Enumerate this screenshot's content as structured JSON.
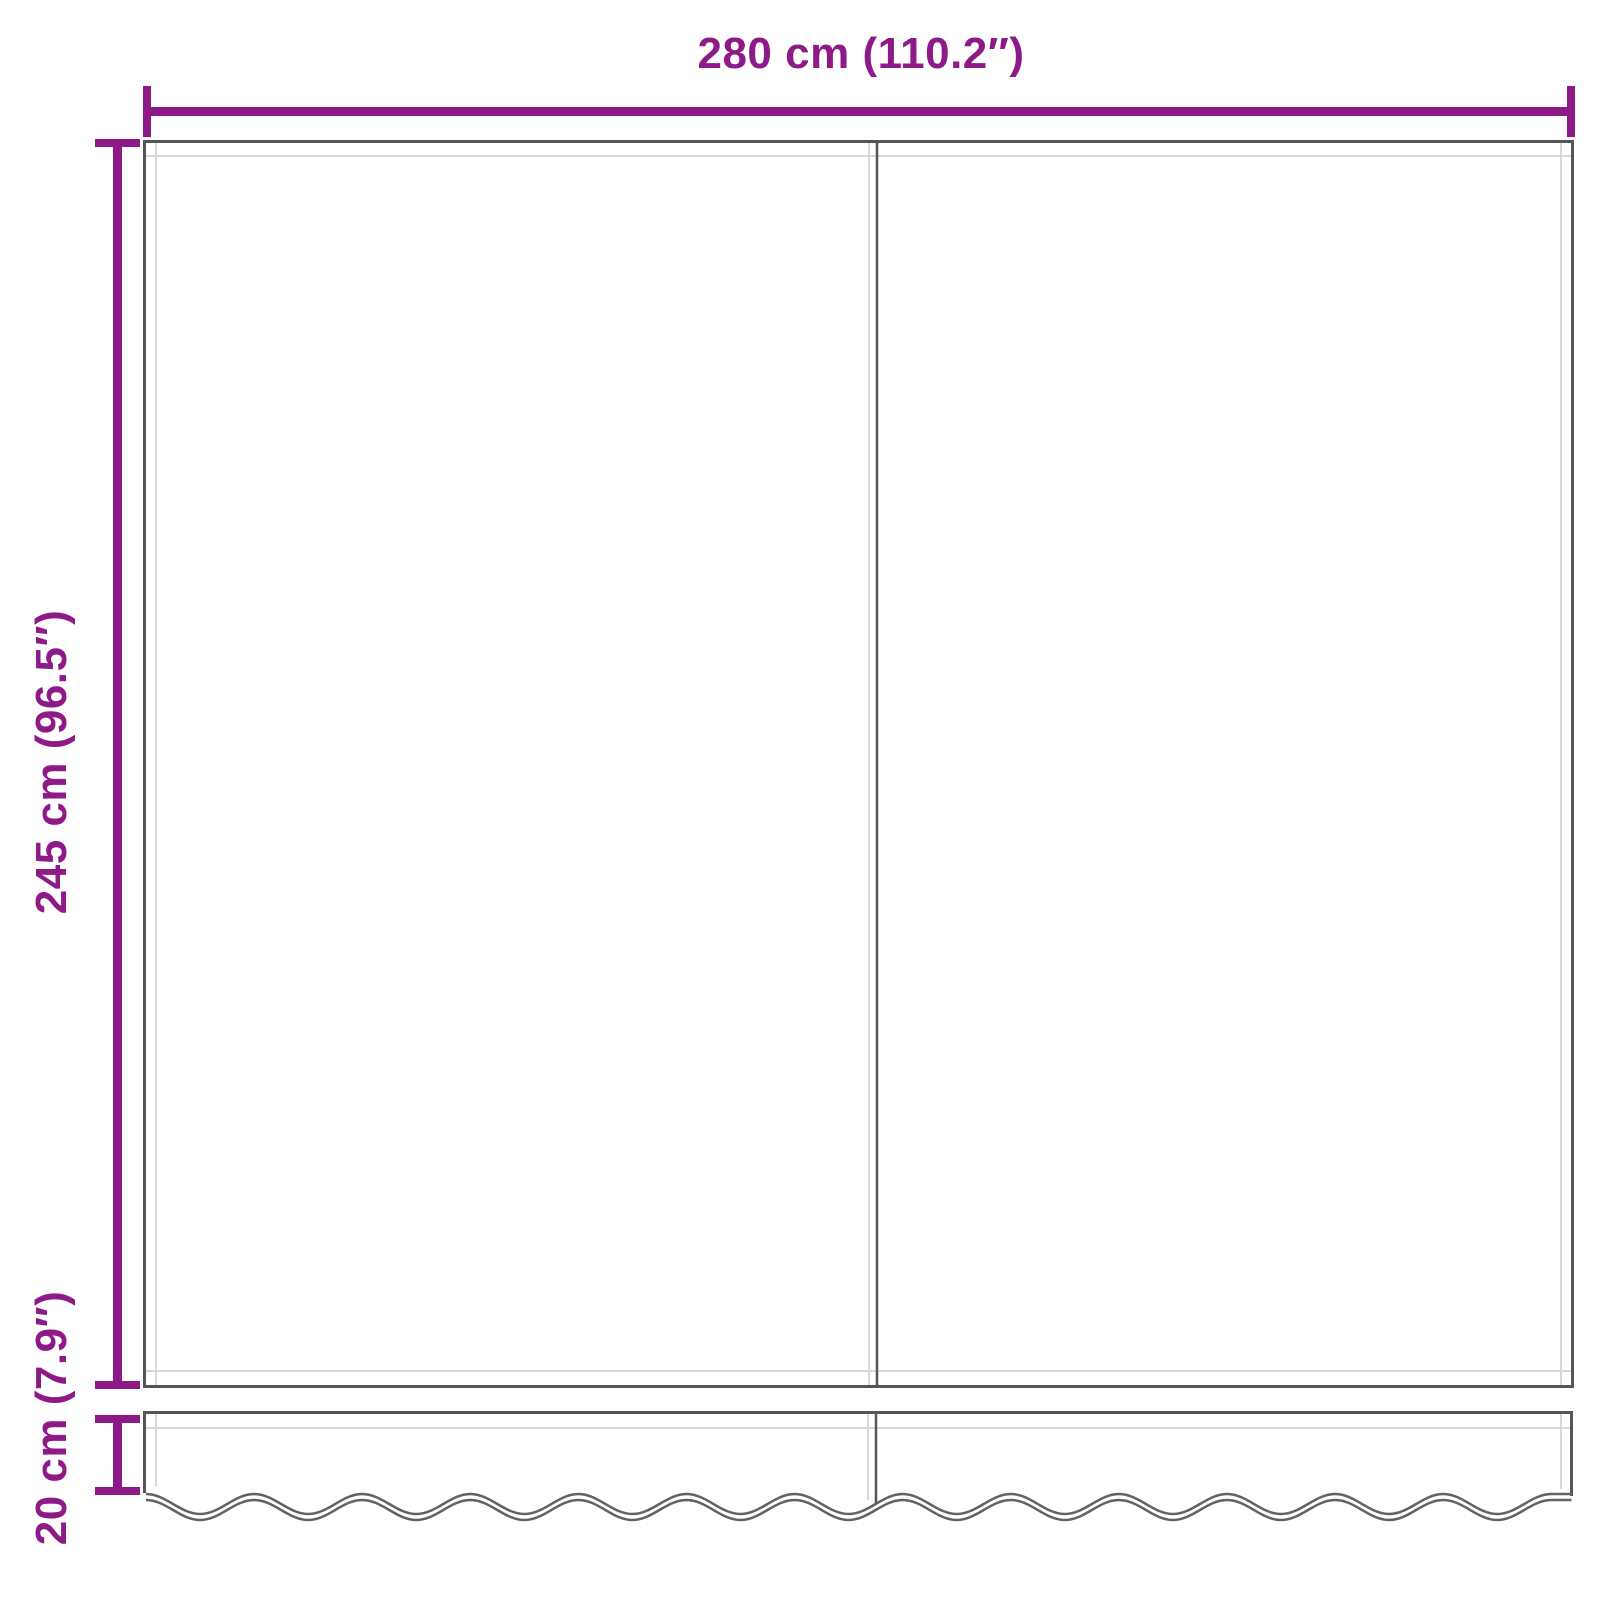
{
  "diagram": {
    "subject": "awning-replacement-fabric-with-valance",
    "dimension_labels": {
      "width": "280 cm (110.2″)",
      "height": "245 cm (96.5″)",
      "valance": "20 cm (7.9″)"
    }
  },
  "colors": {
    "dimension": "#8e1a87",
    "outline": "#56565a",
    "hem_line": "#d8d8d8",
    "scallop_outline": "#626266",
    "background": "#ffffff"
  }
}
